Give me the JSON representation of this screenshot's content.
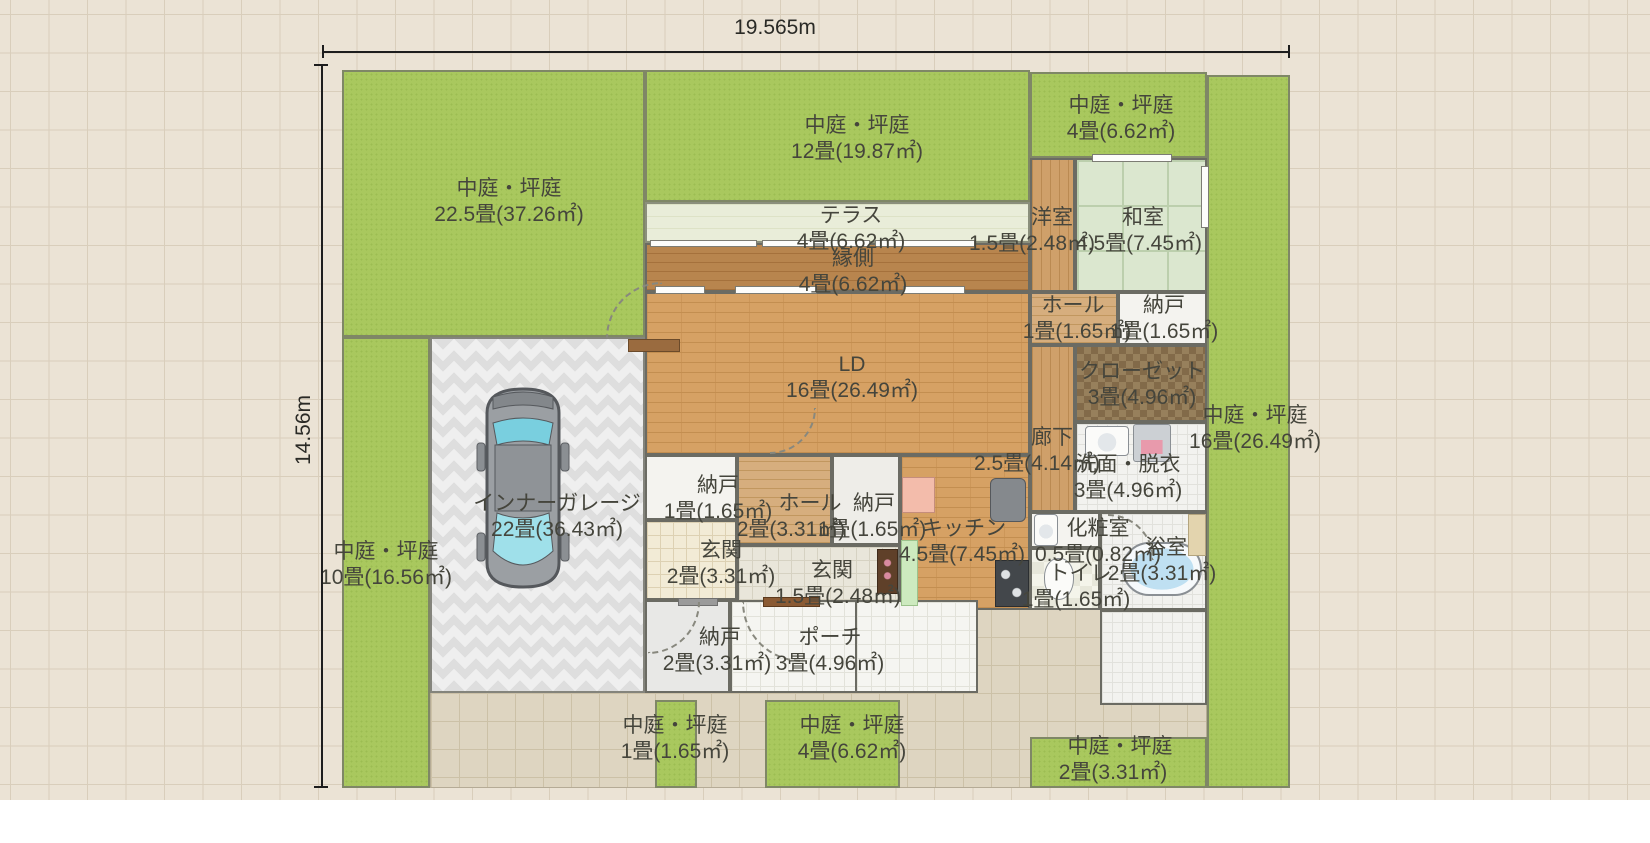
{
  "plan": {
    "lot": {
      "width_label": "19.565m",
      "height_label": "14.56m"
    },
    "regions": [
      {
        "n": "driveway",
        "cls": "f-drive",
        "r": [
          430,
          608,
          777,
          180
        ]
      },
      {
        "n": "garden-northwest",
        "cls": "f-garden",
        "r": [
          342,
          70,
          303,
          267
        ]
      },
      {
        "n": "garden-west",
        "cls": "f-garden",
        "r": [
          342,
          337,
          88,
          451
        ]
      },
      {
        "n": "room-inner-garage",
        "cls": "f-garage",
        "r": [
          430,
          337,
          215,
          356
        ]
      },
      {
        "n": "garden-north",
        "cls": "f-garden",
        "r": [
          645,
          70,
          385,
          132
        ]
      },
      {
        "n": "room-terrace",
        "cls": "f-terrace",
        "r": [
          645,
          202,
          385,
          41
        ]
      },
      {
        "n": "room-engawa",
        "cls": "f-engawa",
        "r": [
          645,
          243,
          385,
          49
        ]
      },
      {
        "n": "garden-northeast",
        "cls": "f-garden",
        "r": [
          1030,
          72,
          177,
          86
        ]
      },
      {
        "n": "room-yoshitsu",
        "cls": "f-wood-v",
        "r": [
          1030,
          158,
          45,
          134
        ]
      },
      {
        "n": "room-washitsu",
        "cls": "f-tatami",
        "r": [
          1075,
          158,
          132,
          134
        ]
      },
      {
        "n": "room-ld",
        "cls": "f-brick",
        "r": [
          645,
          292,
          385,
          163
        ]
      },
      {
        "n": "room-hall-upper",
        "cls": "f-wood-h",
        "r": [
          1030,
          292,
          88,
          53
        ]
      },
      {
        "n": "room-nando-upper-right",
        "cls": "f-plain-white",
        "r": [
          1118,
          292,
          89,
          53
        ]
      },
      {
        "n": "room-closet",
        "cls": "f-closet",
        "r": [
          1075,
          345,
          132,
          77
        ]
      },
      {
        "n": "room-corridor",
        "cls": "f-wood-v",
        "r": [
          1030,
          345,
          45,
          167
        ]
      },
      {
        "n": "room-senmen-datsui",
        "cls": "f-tile-white",
        "r": [
          1075,
          422,
          132,
          90
        ]
      },
      {
        "n": "room-nando-mid-left",
        "cls": "f-plain-white",
        "r": [
          645,
          455,
          92,
          65
        ]
      },
      {
        "n": "room-hall-center",
        "cls": "f-wood-h",
        "r": [
          737,
          455,
          95,
          90
        ]
      },
      {
        "n": "room-nando-mid-right",
        "cls": "f-plain-gray2",
        "r": [
          832,
          455,
          68,
          90
        ]
      },
      {
        "n": "room-kitchen",
        "cls": "f-brick",
        "r": [
          900,
          455,
          130,
          155
        ]
      },
      {
        "n": "room-genkan-west",
        "cls": "f-tile-genkan",
        "r": [
          645,
          520,
          92,
          80
        ]
      },
      {
        "n": "room-genkan-center",
        "cls": "f-tile-genkan2",
        "r": [
          737,
          545,
          163,
          63
        ]
      },
      {
        "n": "room-keshoshitsu",
        "cls": "f-plain-white",
        "r": [
          1030,
          512,
          70,
          36
        ]
      },
      {
        "n": "room-toilet",
        "cls": "f-checker",
        "r": [
          1030,
          548,
          70,
          62
        ]
      },
      {
        "n": "room-bath",
        "cls": "f-tile-white",
        "r": [
          1100,
          512,
          107,
          98
        ]
      },
      {
        "n": "room-nando-south",
        "cls": "f-plain-gray",
        "r": [
          645,
          600,
          85,
          93
        ]
      },
      {
        "n": "room-porch",
        "cls": "f-tile-porch",
        "r": [
          730,
          600,
          130,
          93
        ]
      },
      {
        "n": "porch-apron",
        "cls": "f-tile-porch",
        "r": [
          855,
          600,
          123,
          93
        ]
      },
      {
        "n": "bath-apron",
        "cls": "f-tile-white",
        "r": [
          1100,
          610,
          107,
          95
        ]
      },
      {
        "n": "garden-south-small",
        "cls": "f-garden",
        "r": [
          655,
          700,
          42,
          88
        ]
      },
      {
        "n": "garden-south",
        "cls": "f-garden",
        "r": [
          765,
          700,
          135,
          88
        ]
      },
      {
        "n": "garden-southeast",
        "cls": "f-garden",
        "r": [
          1030,
          737,
          177,
          51
        ]
      },
      {
        "n": "garden-east",
        "cls": "f-garden",
        "r": [
          1207,
          75,
          83,
          713
        ]
      }
    ],
    "fixtures": [
      {
        "n": "window",
        "cls": "f-win",
        "r": [
          655,
          286,
          50,
          8
        ]
      },
      {
        "n": "window",
        "cls": "f-win",
        "r": [
          735,
          286,
          82,
          8
        ]
      },
      {
        "n": "window",
        "cls": "f-win",
        "r": [
          903,
          286,
          62,
          8
        ]
      },
      {
        "n": "window",
        "cls": "f-win",
        "r": [
          650,
          240,
          107,
          7
        ]
      },
      {
        "n": "window",
        "cls": "f-win",
        "r": [
          762,
          240,
          108,
          7
        ]
      },
      {
        "n": "window",
        "cls": "f-win",
        "r": [
          875,
          240,
          100,
          7
        ]
      },
      {
        "n": "window",
        "cls": "f-win",
        "r": [
          1201,
          166,
          8,
          62
        ]
      },
      {
        "n": "window",
        "cls": "f-win",
        "r": [
          1092,
          154,
          80,
          8
        ]
      },
      {
        "n": "entrance-door",
        "cls": "f-door",
        "r": [
          763,
          597,
          57,
          10
        ]
      },
      {
        "n": "nando-door-bar",
        "cls": "f-bar",
        "r": [
          678,
          598,
          40,
          8
        ]
      },
      {
        "n": "garage-step-shelf",
        "cls": "f-shelf",
        "r": [
          628,
          339,
          52,
          13
        ]
      },
      {
        "n": "washbasin",
        "cls": "f-sink",
        "r": [
          1085,
          426,
          44,
          30
        ]
      },
      {
        "n": "washing-machine",
        "cls": "f-washer",
        "r": [
          1133,
          424,
          38,
          38
        ]
      },
      {
        "n": "kitchen-counter-pink",
        "cls": "f-counter-pink",
        "r": [
          902,
          477,
          33,
          36
        ]
      },
      {
        "n": "refrigerator",
        "cls": "f-fridge",
        "r": [
          990,
          478,
          36,
          44
        ]
      },
      {
        "n": "stove",
        "cls": "f-stove",
        "r": [
          995,
          560,
          34,
          47
        ]
      },
      {
        "n": "kitchen-counter-green",
        "cls": "f-counter-green",
        "r": [
          901,
          540,
          17,
          66
        ]
      },
      {
        "n": "shoe-cabinet",
        "cls": "f-cabinet",
        "r": [
          877,
          549,
          21,
          45
        ]
      },
      {
        "n": "bathtub",
        "cls": "f-tub",
        "r": [
          1122,
          542,
          80,
          54
        ]
      },
      {
        "n": "bath-counter",
        "cls": "f-counter-tan",
        "r": [
          1188,
          514,
          18,
          42
        ]
      },
      {
        "n": "toilet-bowl",
        "cls": "f-toilet",
        "r": [
          1044,
          558,
          30,
          42
        ]
      },
      {
        "n": "powder-basin",
        "cls": "f-sink",
        "r": [
          1034,
          514,
          24,
          32
        ]
      },
      {
        "n": "door-swing-arc",
        "cls": "arc arc-tl",
        "r": [
          606,
          282,
          56,
          56
        ],
        "i": "false"
      },
      {
        "n": "door-swing-arc",
        "cls": "arc arc-br",
        "r": [
          770,
          408,
          46,
          46
        ],
        "i": "false"
      },
      {
        "n": "door-swing-arc",
        "cls": "arc arc-br",
        "r": [
          648,
          602,
          52,
          52
        ],
        "i": "false"
      },
      {
        "n": "door-swing-arc",
        "cls": "arc arc-bl",
        "r": [
          742,
          602,
          60,
          60
        ],
        "i": "false"
      },
      {
        "n": "door-swing-arc",
        "cls": "arc arc-tr",
        "r": [
          1108,
          514,
          46,
          46
        ],
        "i": "false"
      }
    ],
    "labels": [
      {
        "n": "label-garden-northwest",
        "l1": "中庭・坪庭",
        "l2": "22.5畳(37.26㎡)",
        "x": 509,
        "y": 176
      },
      {
        "n": "label-garden-north",
        "l1": "中庭・坪庭",
        "l2": "12畳(19.87㎡)",
        "x": 857,
        "y": 113
      },
      {
        "n": "label-garden-northeast",
        "l1": "中庭・坪庭",
        "l2": "4畳(6.62㎡)",
        "x": 1121,
        "y": 93
      },
      {
        "n": "label-terrace",
        "l1": "テラス",
        "l2": "4畳(6.62㎡)",
        "x": 851,
        "y": 203
      },
      {
        "n": "label-engawa",
        "l1": "縁側",
        "l2": "4畳(6.62㎡)",
        "x": 853,
        "y": 246
      },
      {
        "n": "label-yoshitsu",
        "l1": "洋室",
        "l2": "1.5畳(2.48㎡)",
        "x": 1052,
        "y": 205,
        "dx": -20
      },
      {
        "n": "label-washitsu",
        "l1": "和室",
        "l2": "4.5畳(7.45㎡)",
        "x": 1143,
        "y": 205,
        "dx": -4
      },
      {
        "n": "label-ld",
        "l1": "LD",
        "l2": "16畳(26.49㎡)",
        "x": 852,
        "y": 352
      },
      {
        "n": "label-hall-upper",
        "l1": "ホール",
        "l2": "1畳(1.65㎡)",
        "x": 1073,
        "y": 293,
        "dx": 4
      },
      {
        "n": "label-nando-upper-right",
        "l1": "納戸",
        "l2": "1畳(1.65㎡)",
        "x": 1164,
        "y": 293
      },
      {
        "n": "label-closet",
        "l1": "クローゼット",
        "l2": "3畳(4.96㎡)",
        "x": 1142,
        "y": 359
      },
      {
        "n": "label-garden-east",
        "l1": "中庭・坪庭",
        "l2": "16畳(26.49㎡)",
        "x": 1255,
        "y": 403
      },
      {
        "n": "label-corridor",
        "l1": "廊下",
        "l2": "2.5畳(4.14㎡)",
        "x": 1052,
        "y": 425,
        "dx": -15
      },
      {
        "n": "label-senmen",
        "l1": "洗面・脱衣",
        "l2": "3畳(4.96㎡)",
        "x": 1128,
        "y": 452
      },
      {
        "n": "label-garage",
        "l1": "インナーガレージ",
        "l2": "22畳(36.43㎡)",
        "x": 557,
        "y": 491
      },
      {
        "n": "label-garden-west",
        "l1": "中庭・坪庭",
        "l2": "10畳(16.56㎡)",
        "x": 386,
        "y": 539
      },
      {
        "n": "label-nando-mid-left",
        "l1": "納戸",
        "l2": "1畳(1.65㎡)",
        "x": 718,
        "y": 473
      },
      {
        "n": "label-hall-center",
        "l1": "ホール",
        "l2": "2畳(3.31㎡)",
        "x": 810,
        "y": 491,
        "dx": -19
      },
      {
        "n": "label-nando-mid-right",
        "l1": "納戸",
        "l2": "1畳(1.65㎡)",
        "x": 874,
        "y": 491,
        "dx": -2
      },
      {
        "n": "label-genkan-west",
        "l1": "玄関",
        "l2": "2畳(3.31㎡)",
        "x": 721,
        "y": 538
      },
      {
        "n": "label-genkan-center",
        "l1": "玄関",
        "l2": "1.5畳(2.48㎡)",
        "x": 832,
        "y": 558,
        "dx": 6
      },
      {
        "n": "label-kitchen",
        "l1": "キッチン",
        "l2": "4.5畳(7.45㎡)",
        "x": 964,
        "y": 516,
        "dx": -2
      },
      {
        "n": "label-keshoshitsu",
        "l1": "化粧室",
        "l2": "0.5畳(0.82㎡)",
        "x": 1098,
        "y": 516
      },
      {
        "n": "label-bath",
        "l1": "浴室",
        "l2": "2畳(3.31㎡)",
        "x": 1166,
        "y": 535,
        "dx": -4
      },
      {
        "n": "label-toilet",
        "l1": "トイレ",
        "l2": "1畳(1.65㎡)",
        "x": 1080,
        "y": 561,
        "dx": -4
      },
      {
        "n": "label-nando-south",
        "l1": "納戸",
        "l2": "2畳(3.31㎡)",
        "x": 720,
        "y": 625,
        "dx": -3
      },
      {
        "n": "label-porch",
        "l1": "ポーチ",
        "l2": "3畳(4.96㎡)",
        "x": 830,
        "y": 625
      },
      {
        "n": "label-garden-south-small",
        "l1": "中庭・坪庭",
        "l2": "1畳(1.65㎡)",
        "x": 675,
        "y": 713
      },
      {
        "n": "label-garden-south",
        "l1": "中庭・坪庭",
        "l2": "4畳(6.62㎡)",
        "x": 852,
        "y": 713
      },
      {
        "n": "label-garden-southeast",
        "l1": "中庭・坪庭",
        "l2": "2畳(3.31㎡)",
        "x": 1120,
        "y": 734,
        "dx": -7
      }
    ]
  }
}
